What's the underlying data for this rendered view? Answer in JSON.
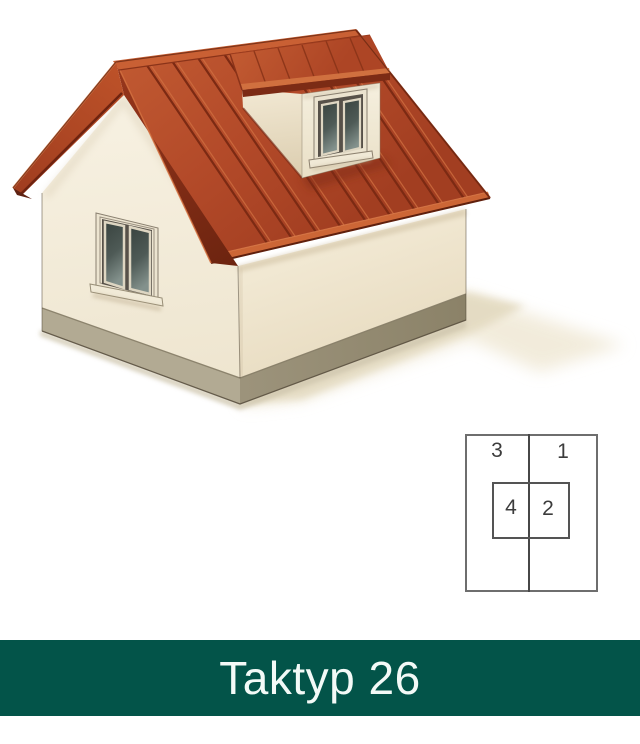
{
  "banner": {
    "label": "Taktyp 26",
    "background_color": "#035449",
    "text_color": "#f3faf7"
  },
  "diagram": {
    "labels": {
      "top_left": "3",
      "top_right": "1",
      "inner_left": "4",
      "inner_right": "2"
    },
    "line_color": "#4f4f4f"
  },
  "house": {
    "roof_color": "#b5492a",
    "roof_seam_color": "#7c2a13",
    "wall_color": "#f3ecd9",
    "plinth_color": "#a39a82",
    "window_glass_color": "#4e5a56",
    "window_frame_color": "#ece4d0",
    "ground_shadow_color": "#e6ddc5"
  }
}
